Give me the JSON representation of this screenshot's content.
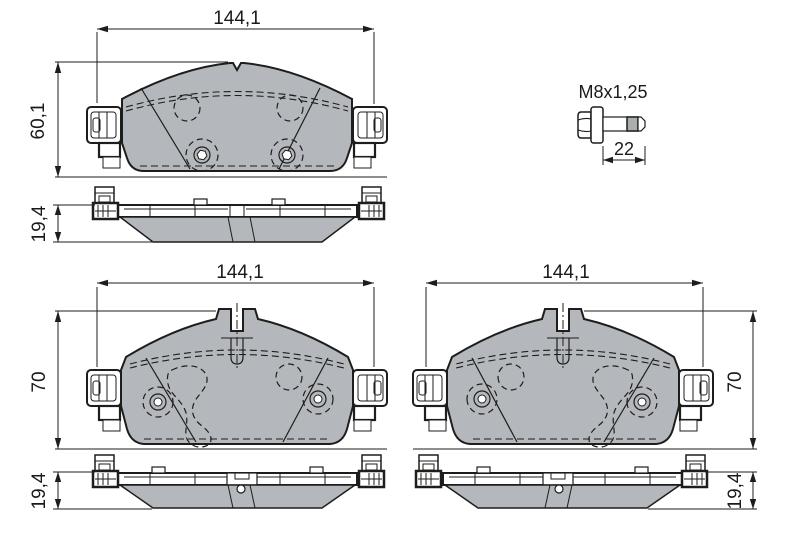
{
  "views": {
    "top": {
      "width_label": "144,1",
      "height_label": "60,1",
      "thickness_label": "19,4"
    },
    "bolt": {
      "thread_label": "M8x1,25",
      "length_label": "22"
    },
    "bottom_left": {
      "width_label": "144,1",
      "height_label": "70",
      "thickness_label": "19,4"
    },
    "bottom_right": {
      "width_label": "144,1",
      "height_label": "70",
      "thickness_label": "19,4"
    }
  },
  "colors": {
    "pad_fill": "#b4b8bc",
    "thread_fill": "#abaeb1",
    "line": "#1d1d1b",
    "background": "#ffffff"
  }
}
